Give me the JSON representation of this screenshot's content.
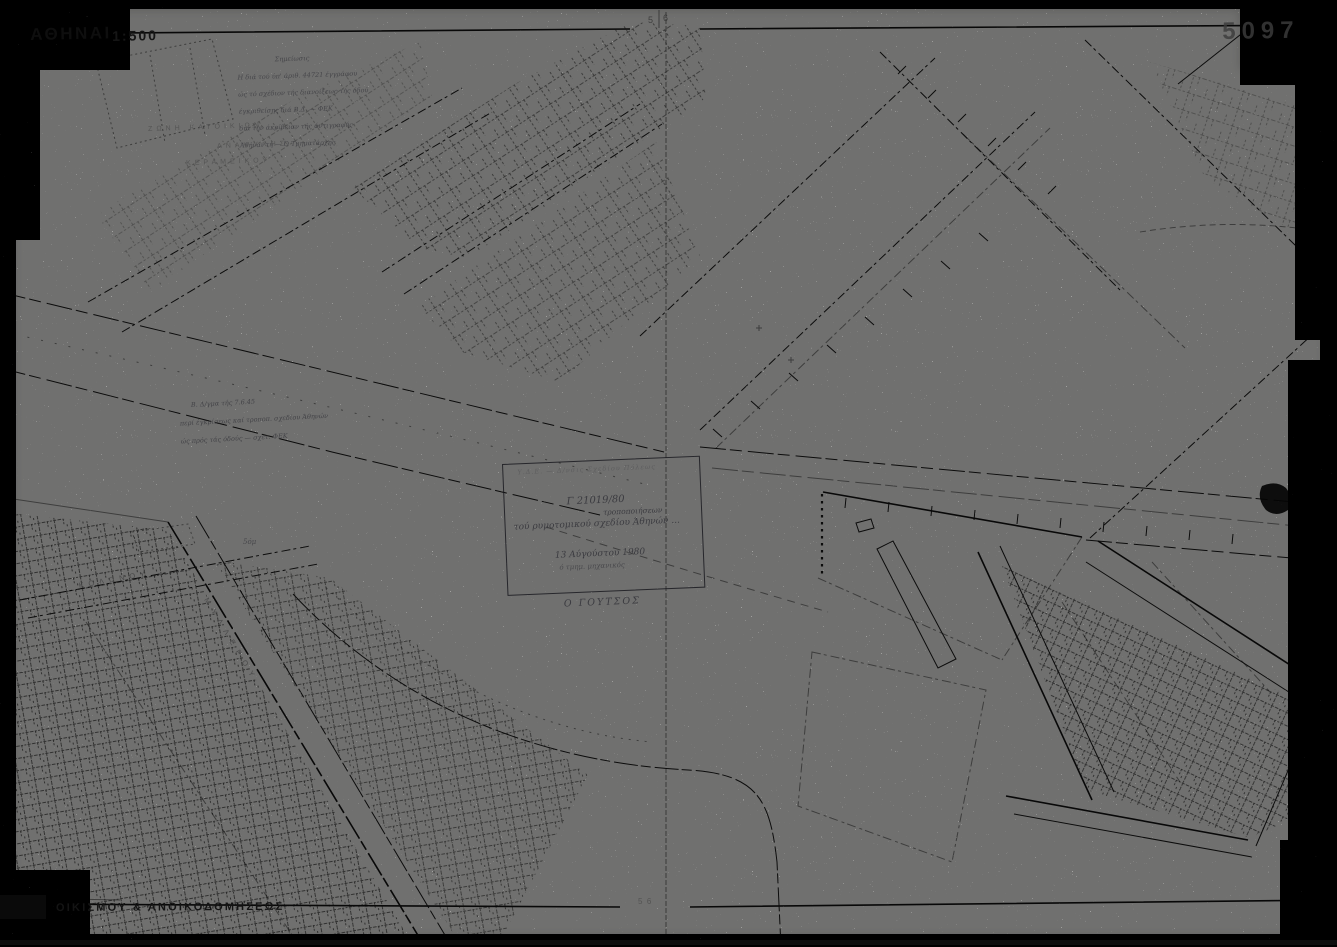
{
  "colors": {
    "paper": "#fbfbf8",
    "ink": "#1a1a1a",
    "faded_ink": "#4a4a4a",
    "stamp_ink": "#26262b"
  },
  "header": {
    "city_label": "ΑΘΗΝΑΙ",
    "scale": "1:500",
    "sheet_number": "5097",
    "join_mark_left": "5",
    "join_mark_right": "6"
  },
  "footer": {
    "agency": "ΟΙΚΙΣΜΟΥ & ΑΝΟΙΚΟΔΟΜΗΣΕΩΣ",
    "join_marks": "5  6"
  },
  "notes": {
    "survey_note": {
      "title": "Σημείωσις",
      "lines": [
        "Η διά τού ύπ' άριθ. 44721 έγγράφου",
        "ώς τό σχέδιον τής διανοίξεως τής όδού",
        "έγκριθείσης διά Β.Δ. — ΦΕΚ",
        "διά τήν άκρίβειαν τής άντιγραφής",
        "Άθήναι τή — Ό Τμηματάρχης"
      ]
    },
    "decree_note": {
      "lines": [
        "Β. Δ/γμα τής 7.6.45",
        "περί έγκρίσεως καί τροποπ. σχεδίου Άθηνών",
        "ώς πρός τάς όδούς — σχετ. ΦΕΚ"
      ]
    },
    "distance_marker": "5όμ"
  },
  "labels": {
    "zone_label_1": "ΖΩΝΗ ΚΑΤΟΙΚΙΩΝ",
    "zone_label_2": "ΑΝΑΨΥΧΗΣ",
    "zone_label_3": "ΚΕΡΑΜΕΙΚΟΥ",
    "street_label_1": "ΚΟΛΩΝΟΥ",
    "street_label_2": "ΜΥΛΛΕΡΟΥ"
  },
  "stamp": {
    "header": "Υ.Δ.Ε. — Δ/νσις Σχεδίου Πόλεως",
    "reference": "Γ 21019/80",
    "overline": "τροποποιήσεων",
    "subject": "τού ρυμοτομικού σχεδίου Άθηνών ...",
    "date": "13 Αύγούστου 1980",
    "role": "ό τμημ. μηχανικός",
    "signature": "Ο ΓΟΥΤΣΟΣ"
  }
}
